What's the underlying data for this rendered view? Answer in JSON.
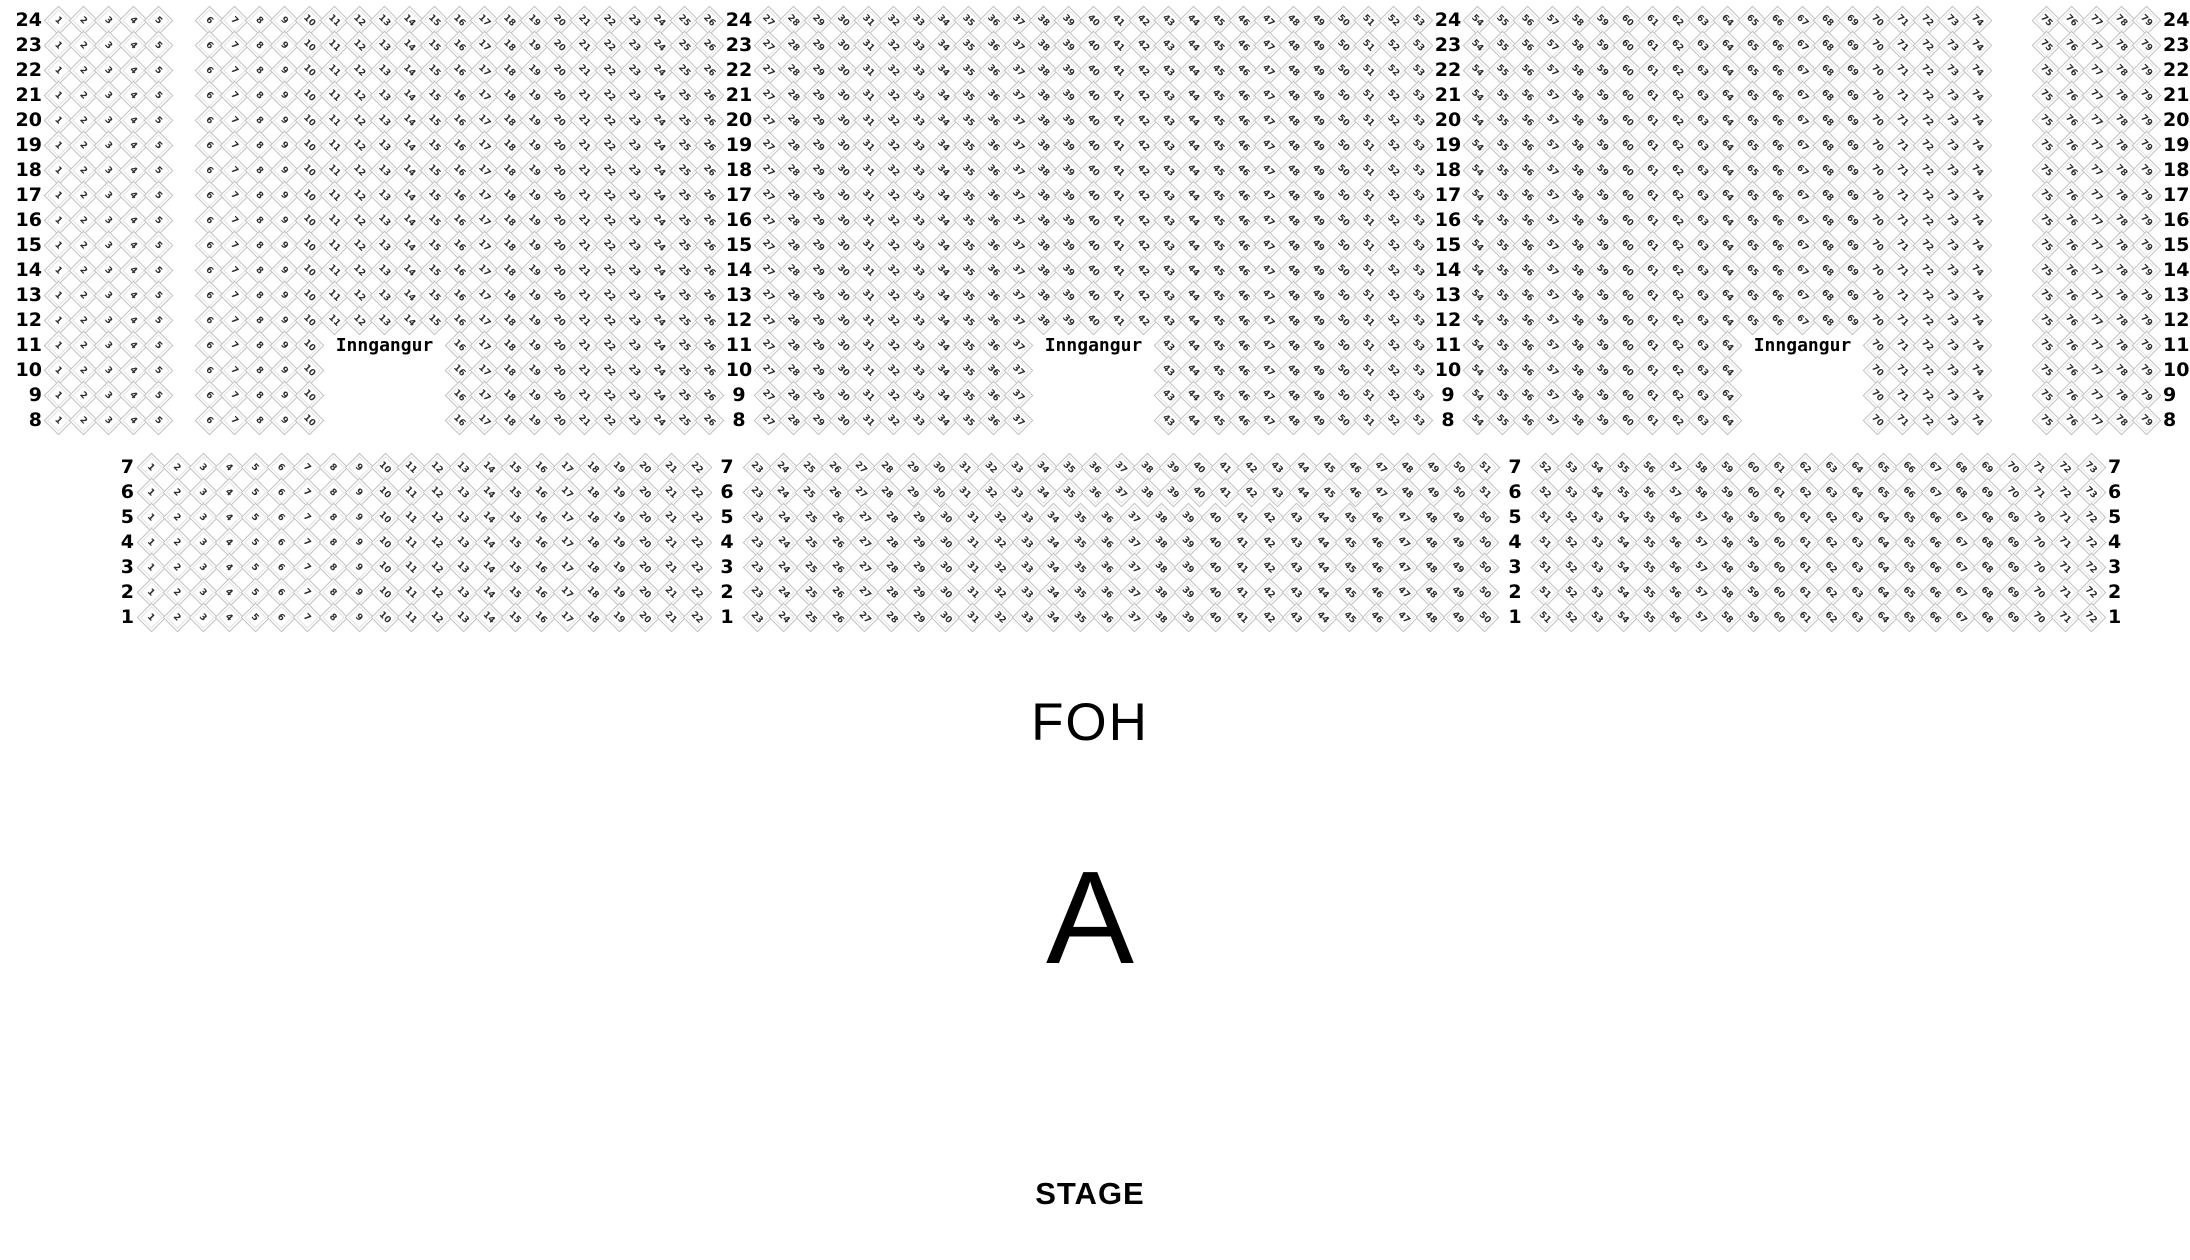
{
  "labels": {
    "entrance": "Inngangur",
    "foh": "FOH",
    "section": "A",
    "stage": "STAGE"
  },
  "colors": {
    "background": "#ffffff",
    "seat_fill": "#ffffff",
    "seat_border": "#c3c3c3",
    "seat_number": "#2d2d2d",
    "text": "#000000"
  },
  "top_block": {
    "full_rows": [
      24,
      23,
      22,
      21,
      20,
      19,
      18,
      17,
      16,
      15,
      14,
      13,
      12
    ],
    "entrance_rows": [
      11,
      10,
      9,
      8
    ],
    "entrance_text_row": 11,
    "groups_full": [
      [
        [
          1,
          5
        ]
      ],
      [
        [
          6,
          26
        ]
      ],
      [
        [
          27,
          53
        ]
      ],
      [
        [
          54,
          74
        ]
      ],
      [
        [
          75,
          79
        ]
      ]
    ],
    "groups_entrance": [
      [
        [
          1,
          5
        ]
      ],
      [
        [
          6,
          10
        ],
        [
          16,
          26
        ]
      ],
      [
        [
          27,
          37
        ],
        [
          43,
          53
        ]
      ],
      [
        [
          54,
          64
        ],
        [
          70,
          74
        ]
      ],
      [
        [
          75,
          79
        ]
      ]
    ]
  },
  "bottom_block": {
    "rows": [
      {
        "row": 7,
        "groups": [
          [
            1,
            22
          ],
          [
            23,
            51
          ],
          [
            52,
            73
          ]
        ]
      },
      {
        "row": 6,
        "groups": [
          [
            1,
            22
          ],
          [
            23,
            51
          ],
          [
            52,
            73
          ]
        ]
      },
      {
        "row": 5,
        "groups": [
          [
            1,
            22
          ],
          [
            23,
            50
          ],
          [
            51,
            72
          ]
        ]
      },
      {
        "row": 4,
        "groups": [
          [
            1,
            22
          ],
          [
            23,
            50
          ],
          [
            51,
            72
          ]
        ]
      },
      {
        "row": 3,
        "groups": [
          [
            1,
            22
          ],
          [
            23,
            50
          ],
          [
            51,
            72
          ]
        ]
      },
      {
        "row": 2,
        "groups": [
          [
            1,
            22
          ],
          [
            23,
            50
          ],
          [
            51,
            72
          ]
        ]
      },
      {
        "row": 1,
        "groups": [
          [
            1,
            22
          ],
          [
            23,
            50
          ],
          [
            51,
            72
          ]
        ]
      }
    ]
  }
}
